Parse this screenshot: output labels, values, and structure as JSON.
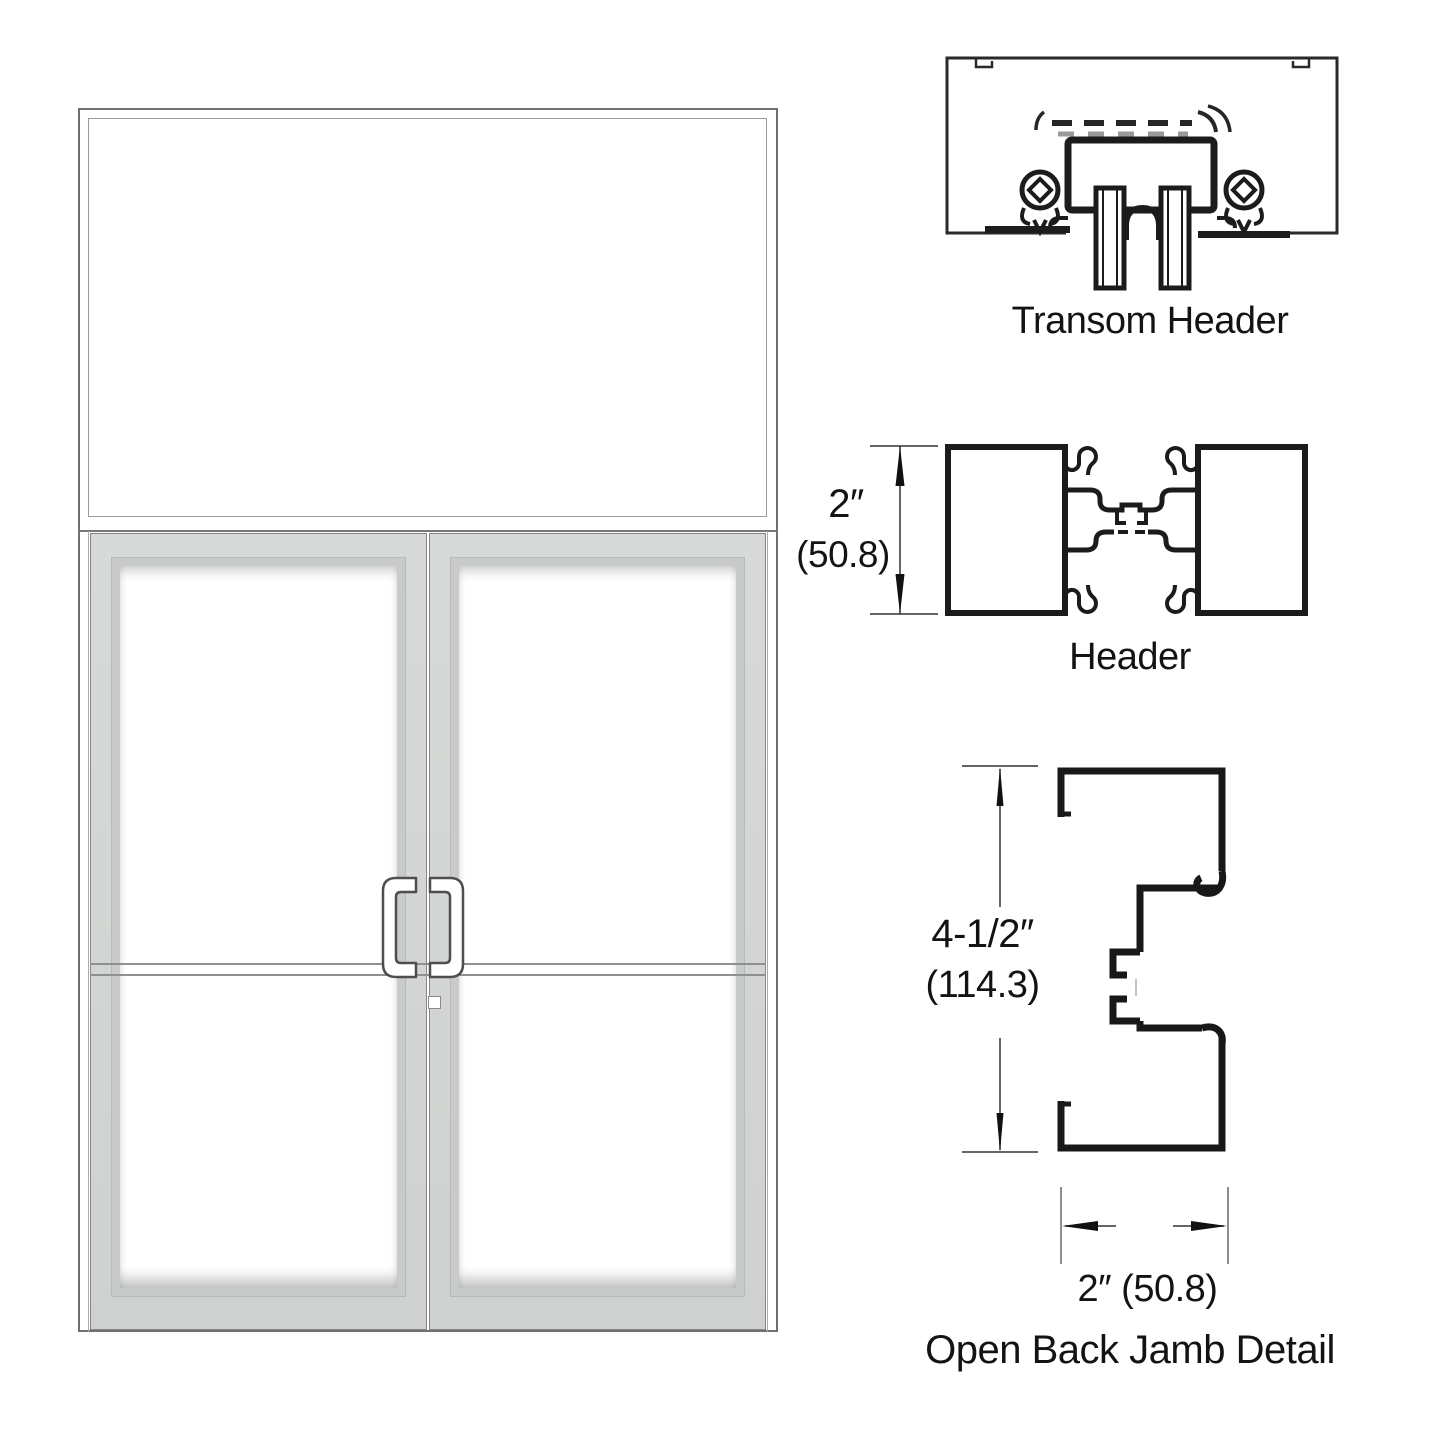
{
  "colors": {
    "profile_line": "#1b1b1b",
    "frame_gray": "#d4d6d5",
    "dimension_line": "#333333",
    "text": "#131313"
  },
  "details": {
    "transom_header": {
      "label": "Transom Header"
    },
    "header": {
      "label": "Header",
      "dim_height_in": "2″",
      "dim_height_mm": "(50.8)"
    },
    "open_back_jamb": {
      "label": "Open Back Jamb Detail",
      "dim_height_in": "4-1/2″",
      "dim_height_mm": "(114.3)",
      "dim_width": "2″ (50.8)"
    }
  }
}
